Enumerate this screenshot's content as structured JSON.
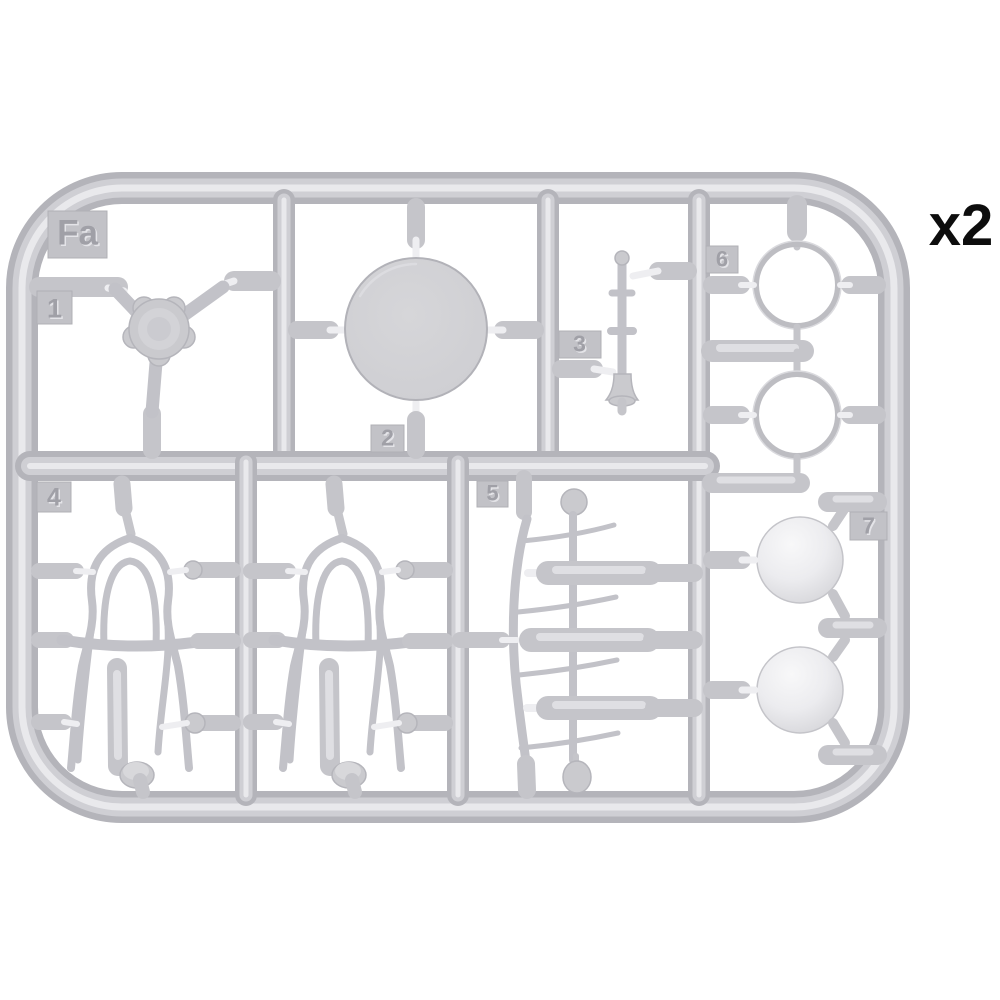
{
  "page": {
    "background_color": "#ffffff"
  },
  "sprue": {
    "tag": "Fa",
    "quantity_label": "x2",
    "plastic_color": "#c8c8cc",
    "plastic_highlight": "#e9e9ec",
    "plastic_shadow": "#b4b4ba",
    "engraved_label_color": "#a0a0a7",
    "quantity_text_color": "#0d0d0d",
    "part_numbers": {
      "p1": "1",
      "p2": "2",
      "p3": "3",
      "p4": "4",
      "p5": "5",
      "p6": "6",
      "p7": "7"
    }
  }
}
